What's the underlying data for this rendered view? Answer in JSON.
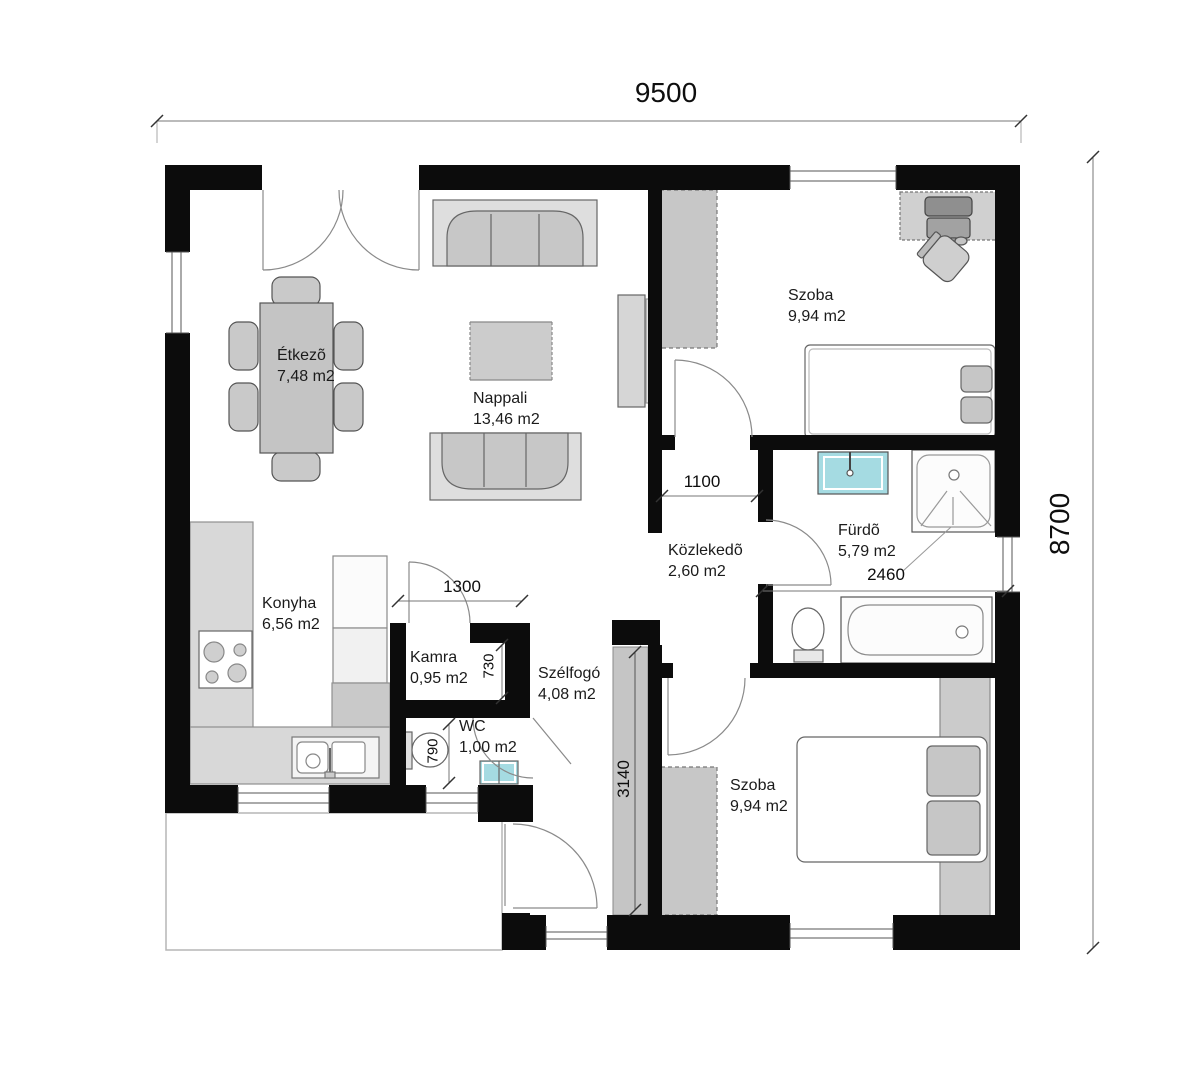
{
  "dimensions": {
    "overall_width": "9500",
    "overall_height": "8700",
    "hall_opening": "1100",
    "bathroom_width": "2460",
    "kamra_width": "1300",
    "kamra_depth": "730",
    "wc_width": "790",
    "partition_length": "3140"
  },
  "rooms": {
    "etkezo": {
      "name": "Étkezõ",
      "area": "7,48 m2"
    },
    "nappali": {
      "name": "Nappali",
      "area": "13,46 m2"
    },
    "szoba1": {
      "name": "Szoba",
      "area": "9,94 m2"
    },
    "furdo": {
      "name": "Fürdõ",
      "area": "5,79 m2"
    },
    "kozlekedo": {
      "name": "Közlekedõ",
      "area": "2,60 m2"
    },
    "konyha": {
      "name": "Konyha",
      "area": "6,56 m2"
    },
    "kamra": {
      "name": "Kamra",
      "area": "0,95 m2"
    },
    "wc": {
      "name": "WC",
      "area": "1,00 m2"
    },
    "szelfogo": {
      "name": "Szélfogó",
      "area": "4,08 m2"
    },
    "szoba2": {
      "name": "Szoba",
      "area": "9,94 m2"
    }
  },
  "colors": {
    "wall": "#0c0c0c",
    "furniture_gray": "#c7c7c7",
    "fixture_blue": "#a5dbe2",
    "dimension_text": "#0e0e0e"
  }
}
